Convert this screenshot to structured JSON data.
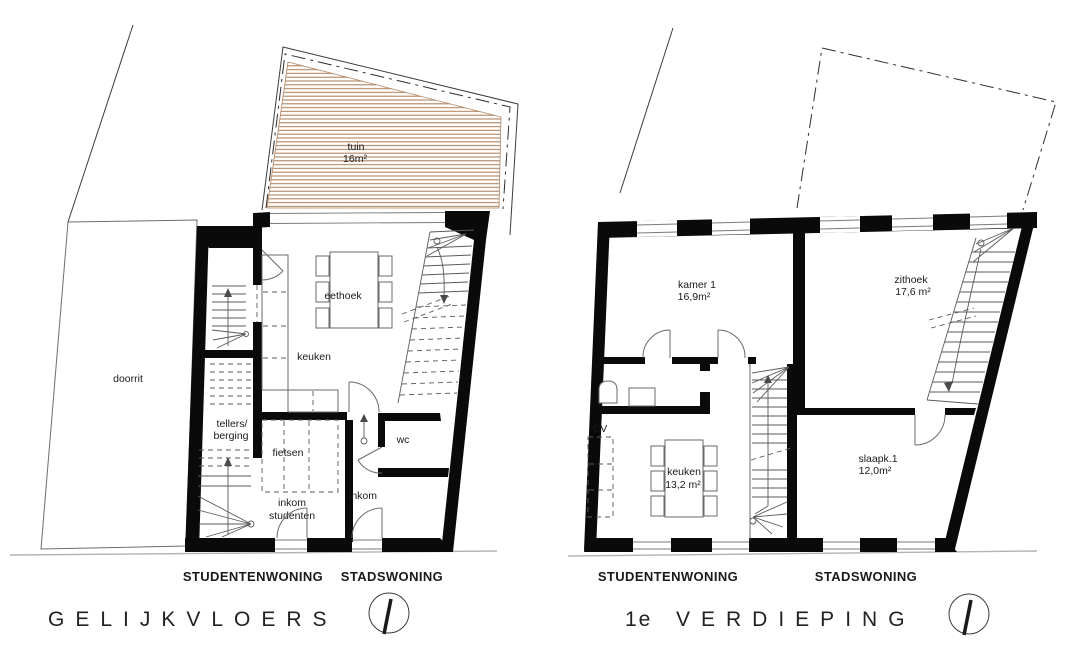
{
  "document": {
    "kind": "architectural floor plan drawing",
    "background": "#ffffff"
  },
  "colors": {
    "walls": "#0a0a0a",
    "thin_line": "#3c3c3c",
    "furniture_line": "#6a6a6a",
    "garden_stripe": "#b1835f",
    "street_line": "#b3b3b3",
    "text": "#1a1a1a"
  },
  "plans": [
    {
      "title": "GELIJKVLOERS",
      "title_prefix": "",
      "units": {
        "left": "STUDENTENWONING",
        "right": "STADSWONING"
      },
      "rooms": {
        "doorrit": {
          "label": "doorrit"
        },
        "tuin": {
          "label": "tuin",
          "area": "16m²"
        },
        "eethoek": {
          "label": "eethoek"
        },
        "keuken": {
          "label": "keuken"
        },
        "tellers": {
          "line1": "tellers/",
          "line2": "berging"
        },
        "fietsen": {
          "label": "fietsen"
        },
        "inkom_studenten": {
          "line1": "inkom",
          "line2": "studenten"
        },
        "inkom": {
          "label": "inkom"
        },
        "wc": {
          "label": "wc"
        }
      }
    },
    {
      "title": "VERDIEPING",
      "title_prefix": "1e",
      "units": {
        "left": "STUDENTENWONING",
        "right": "STADSWONING"
      },
      "rooms": {
        "kamer1": {
          "label": "kamer 1",
          "area": "16,9m²"
        },
        "zithoek": {
          "label": "zithoek",
          "area": "17,6 m²"
        },
        "cv": {
          "label": "CV"
        },
        "keuken": {
          "label": "keuken",
          "area": "13,2 m²"
        },
        "slaapk1": {
          "label": "slaapk.1",
          "area": "12,0m²"
        }
      }
    }
  ]
}
